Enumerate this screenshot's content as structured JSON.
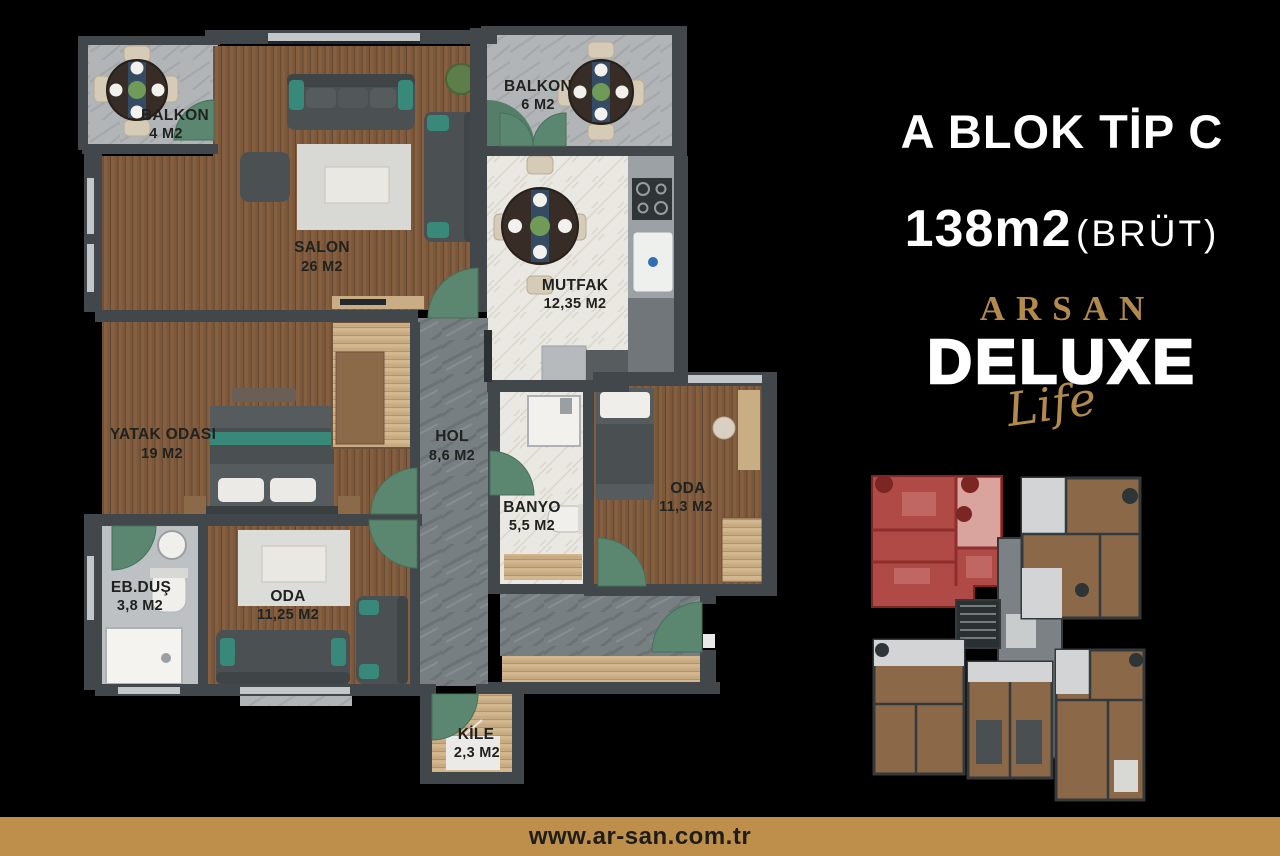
{
  "header": {
    "title": "A BLOK TİP C",
    "area_value": "138m2",
    "area_note": "(BRÜT)"
  },
  "brand": {
    "name": "ARSAN",
    "line": "DELUXE",
    "script": "Life"
  },
  "footer": {
    "website": "www.ar-san.com.tr"
  },
  "plan": {
    "rooms": [
      {
        "name": "BALKON",
        "area": "4 M2"
      },
      {
        "name": "SALON",
        "area": "26 M2"
      },
      {
        "name": "BALKON",
        "area": "6 M2"
      },
      {
        "name": "MUTFAK",
        "area": "12,35 M2"
      },
      {
        "name": "YATAK ODASI",
        "area": "19 M2"
      },
      {
        "name": "HOL",
        "area": "8,6 M2"
      },
      {
        "name": "BANYO",
        "area": "5,5 M2"
      },
      {
        "name": "ODA",
        "area": "11,3 M2"
      },
      {
        "name": "EB.DUŞ",
        "area": "3,8 M2"
      },
      {
        "name": "ODA",
        "area": "11,25 M2"
      },
      {
        "name": "KİLE",
        "area": "2,3 M2"
      }
    ]
  },
  "colors": {
    "gold": "#bd8f4a",
    "highlight_red": "#b04a47",
    "wall_gray": "#41474a",
    "wood_brown": "#7b583b",
    "door_green": "#5b8770",
    "accent_teal": "#39897a"
  }
}
